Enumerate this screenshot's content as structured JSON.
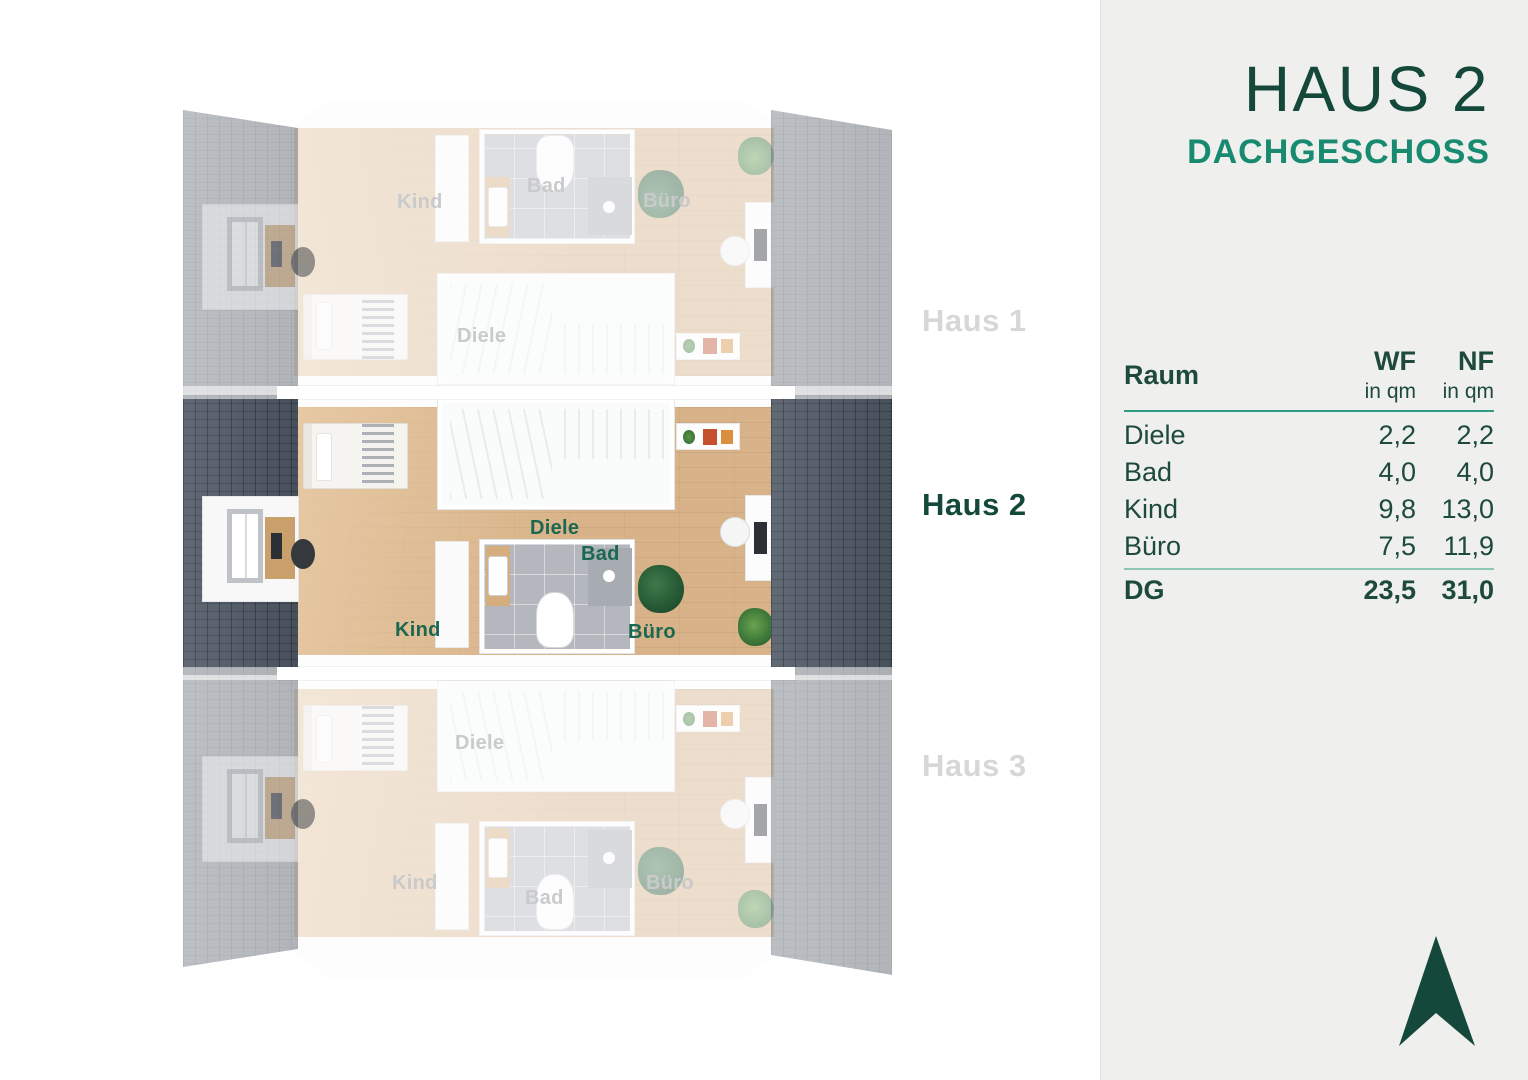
{
  "header": {
    "title": "HAUS 2",
    "subtitle": "DACHGESCHOSS"
  },
  "table": {
    "room_header": "Raum",
    "columns": [
      {
        "label": "WF",
        "unit": "in qm"
      },
      {
        "label": "NF",
        "unit": "in qm"
      }
    ],
    "rows": [
      {
        "room": "Diele",
        "wf": "2,2",
        "nf": "2,2"
      },
      {
        "room": "Bad",
        "wf": "4,0",
        "nf": "4,0"
      },
      {
        "room": "Kind",
        "wf": "9,8",
        "nf": "13,0"
      },
      {
        "room": "Büro",
        "wf": "7,5",
        "nf": "11,9"
      }
    ],
    "total": {
      "room": "DG",
      "wf": "23,5",
      "nf": "31,0"
    }
  },
  "floorplan": {
    "house_labels": [
      {
        "label": "Haus 1",
        "active": false
      },
      {
        "label": "Haus 2",
        "active": true
      },
      {
        "label": "Haus 3",
        "active": false
      }
    ],
    "room_labels": {
      "diele": "Diele",
      "bad": "Bad",
      "kind": "Kind",
      "buero": "Büro"
    }
  },
  "logo": {
    "icon": "north-arrow"
  },
  "colors": {
    "title_green": "#14483a",
    "teal": "#178a70",
    "table_text": "#1e4a3e",
    "table_line": "#2f9c83",
    "total_line": "#8ec6b6",
    "inactive_gray": "#d7d7d8",
    "room_label_green": "#1c6750",
    "roof_dark": "#4f5965",
    "wood_light": "#e6c9a4",
    "wood_dark": "#d8b288",
    "bad_gray": "#b4b8be",
    "panel_bg": "#efefee"
  }
}
